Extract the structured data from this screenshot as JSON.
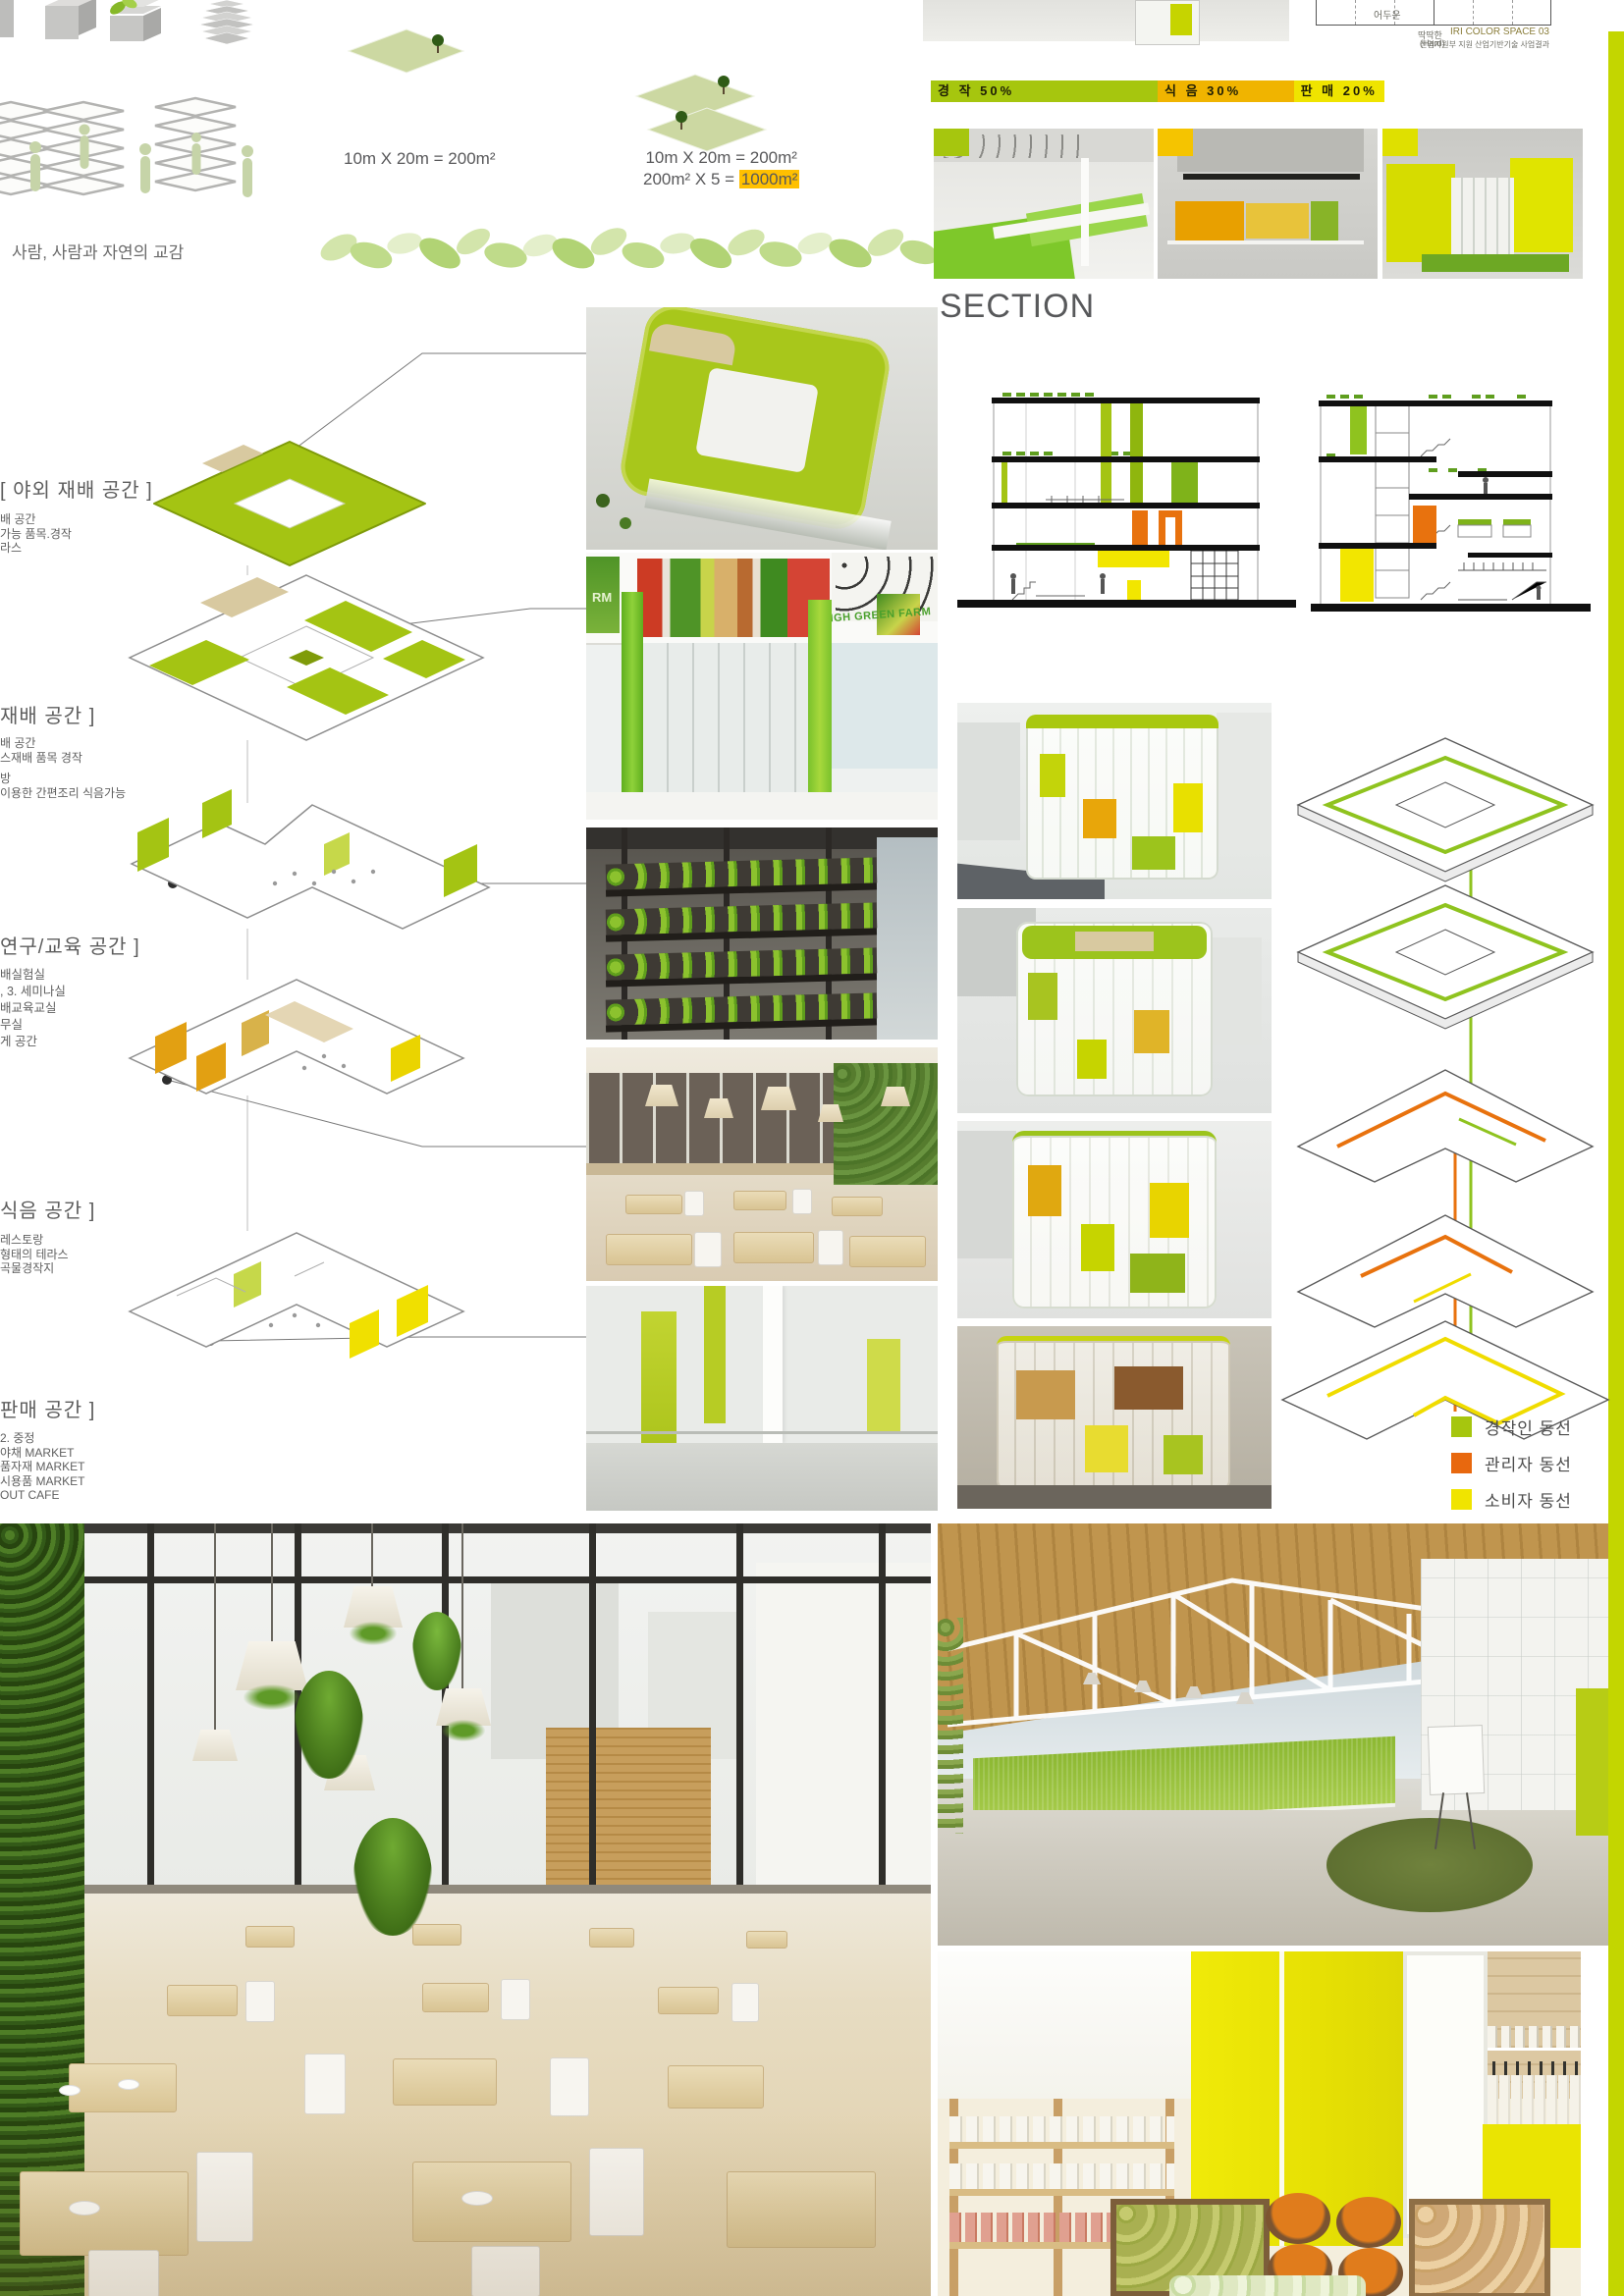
{
  "top": {
    "caption": "사람, 사람과 자연의 교감",
    "area_left": "10m X 20m = 200m²",
    "area_right_1": "10m X 20m = 200m²",
    "area_right_2a": "200m²  X  5 = ",
    "area_right_2b": "1000m²"
  },
  "program_bar": {
    "segments": [
      {
        "label": "경 작 50%",
        "percent": 50,
        "color": "#a6c60e"
      },
      {
        "label": "식 음 30%",
        "percent": 30,
        "color": "#f0b400"
      },
      {
        "label": "판 매 20%",
        "percent": 20,
        "color": "#efe400"
      }
    ]
  },
  "iri_chart": {
    "cell": "어두운",
    "hard1": "딱딱한",
    "hard2": "(Hard)",
    "source": "IRI COLOR SPACE 03",
    "credit": "산업자원부 지원 산업기반기술 사업결과"
  },
  "section": {
    "title": "SECTION"
  },
  "spaces": [
    {
      "title": "[ 야외 재배 공간 ]",
      "lines": [
        "배 공간",
        "가능 품목.경작",
        "라스"
      ]
    },
    {
      "title": "재배 공간 ]",
      "lines": [
        "배 공간",
        "스재배 품목 경작",
        "방",
        "이용한 간편조리 식음가능"
      ]
    },
    {
      "title": "연구/교육 공간 ]",
      "lines": [
        "배실험실",
        ",  3. 세미나실",
        "배교육교실",
        "무실",
        "게 공간"
      ]
    },
    {
      "title": "식음 공간 ]",
      "lines": [
        "레스토랑",
        "형태의 테라스",
        "곡물경작지"
      ]
    },
    {
      "title": "판매 공간 ]",
      "lines": [
        "2. 중정",
        "야채 MARKET",
        "품자재 MARKET",
        "시용품 MARKET",
        "OUT CAFE"
      ]
    }
  ],
  "legend": {
    "items": [
      {
        "label": "경작인 동선",
        "color": "#a6c60e"
      },
      {
        "label": "관리자 동선",
        "color": "#e8680e"
      },
      {
        "label": "소비자 동선",
        "color": "#f0e400"
      }
    ]
  },
  "facade": {
    "banner": "HIGH GREEN FARM",
    "banner_partial": "RM"
  },
  "colors": {
    "chartreuse": "#a6c60e",
    "gold": "#f0b400",
    "yellow": "#efe400",
    "orange": "#e8680e",
    "edge_strip": "#c3d600",
    "highlight": "#ffc000"
  }
}
